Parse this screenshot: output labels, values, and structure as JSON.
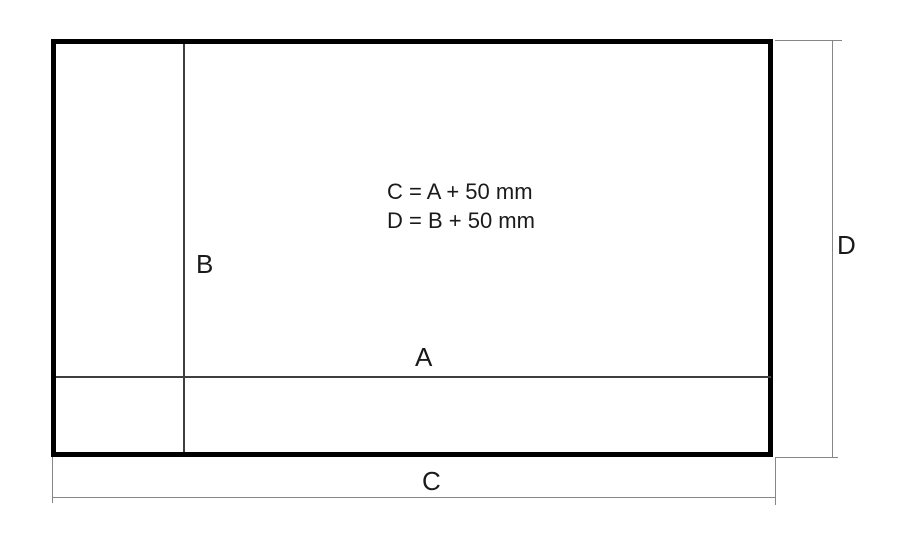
{
  "canvas": {
    "width": 900,
    "height": 546,
    "background": "#ffffff"
  },
  "diagram": {
    "type": "dimensioned-technical-drawing",
    "labels": {
      "a": "A",
      "b": "B",
      "c": "C",
      "d": "D"
    },
    "formulas": {
      "line1": "C = A + 50 mm",
      "line2": "D = B + 50 mm"
    },
    "colors": {
      "outer_border": "#000000",
      "inner_line": "#3f3f3f",
      "dimension_line": "#868686",
      "text": "#1a1a1a"
    }
  }
}
